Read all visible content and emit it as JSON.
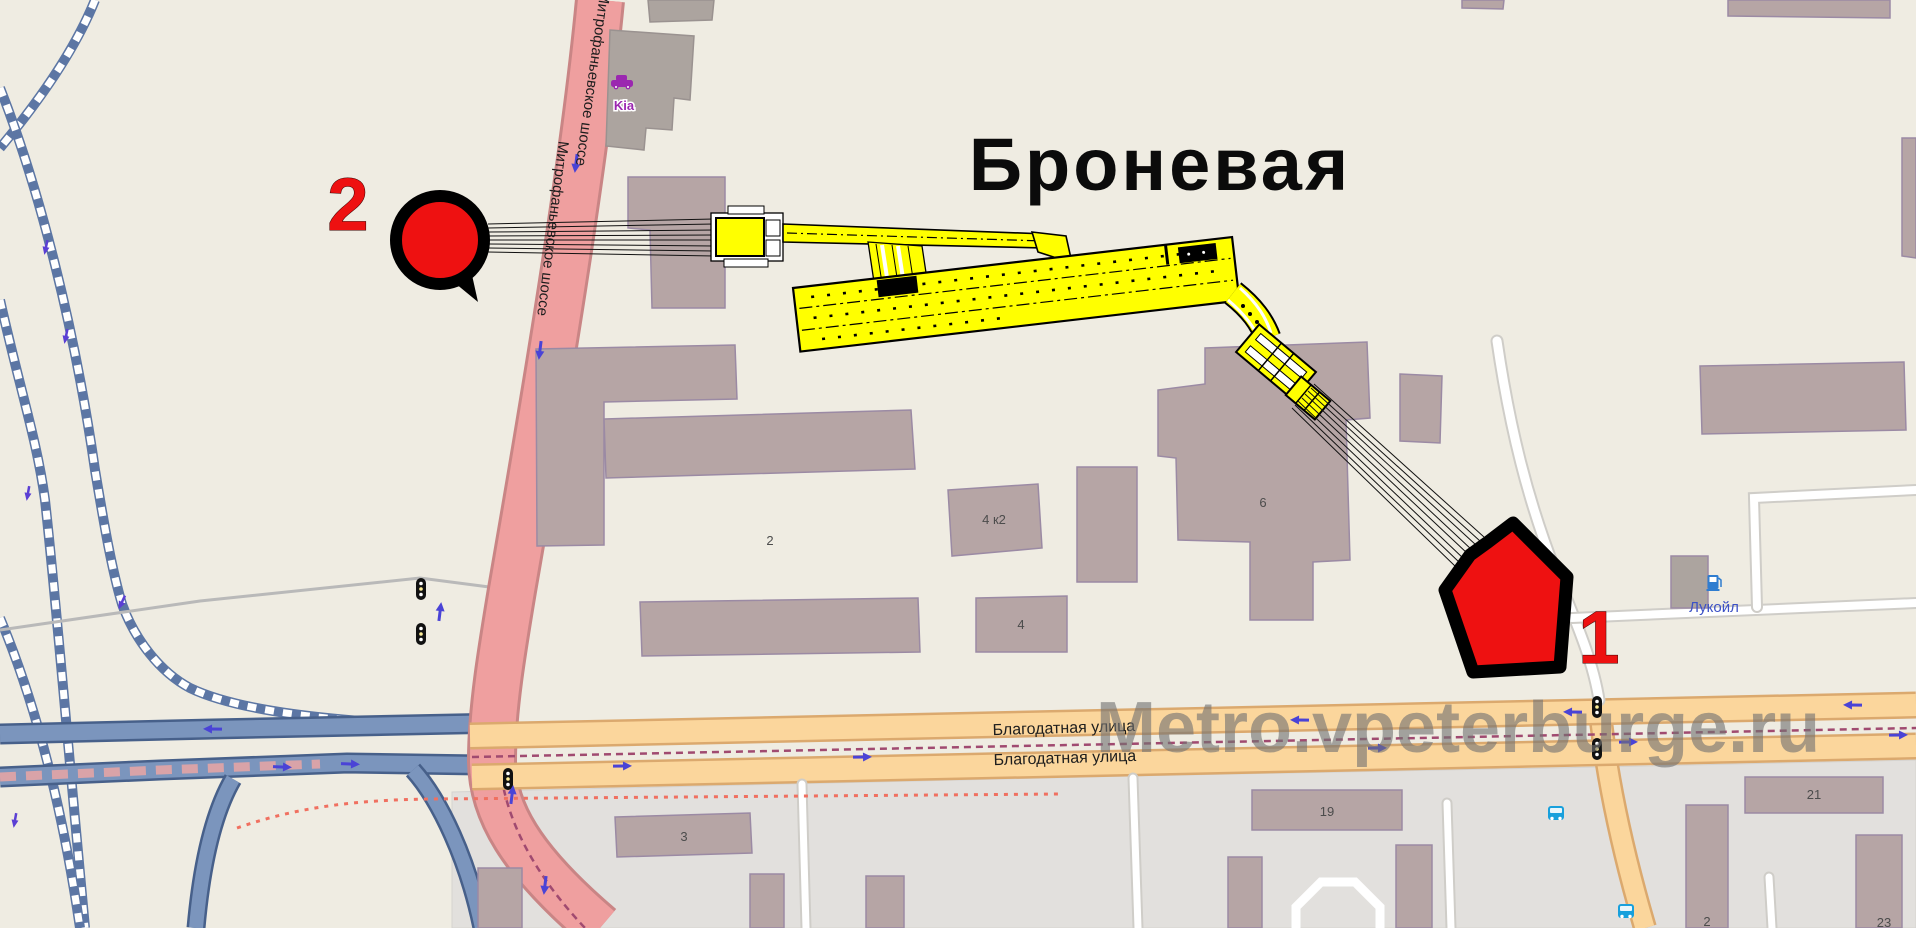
{
  "page": {
    "title": "Броневая",
    "watermark": "Metro.vpeterburge.ru"
  },
  "markers": {
    "exit1": "1",
    "exit2": "2"
  },
  "streets": {
    "blagodatnaya_upper": "Благодатная улица",
    "blagodatnaya_lower": "Благодатная улица",
    "mitrofanyevskoe_upper": "Митрофаньевское шоссе",
    "mitrofanyevskoe_lower": "Митрофаньевское шоссе"
  },
  "pois": {
    "car_dealer": "Kia",
    "fuel_station": "Лукойл"
  },
  "building_numbers": {
    "b2": "2",
    "b4k2": "4 к2",
    "b4": "4",
    "b6": "6",
    "b3": "3",
    "b19": "19",
    "b21": "21",
    "b2_south": "2",
    "b23": "23"
  },
  "icons": {
    "car_dealer": "car-dealer-icon",
    "fuel_station": "fuel-pump-icon",
    "bus_stop": "bus-stop-icon",
    "traffic_signal": "traffic-signal-icon",
    "direction_arrow": "one-way-arrow-icon"
  },
  "colors": {
    "background_cream": "#efece2",
    "industrial_gray": "#e2e0dd",
    "building_fill": "#b6a5a5",
    "trunk_road_pink": "#ef9f9f",
    "secondary_road_orange": "#fbd69c",
    "bridge_road_blue": "#7b95bd",
    "railway_blue": "#5c76a4",
    "tram_line_purple": "#a04a70",
    "metro_station_yellow": "#ffff00",
    "marker_red": "#ee1111",
    "watermark_gray": "#737373"
  }
}
